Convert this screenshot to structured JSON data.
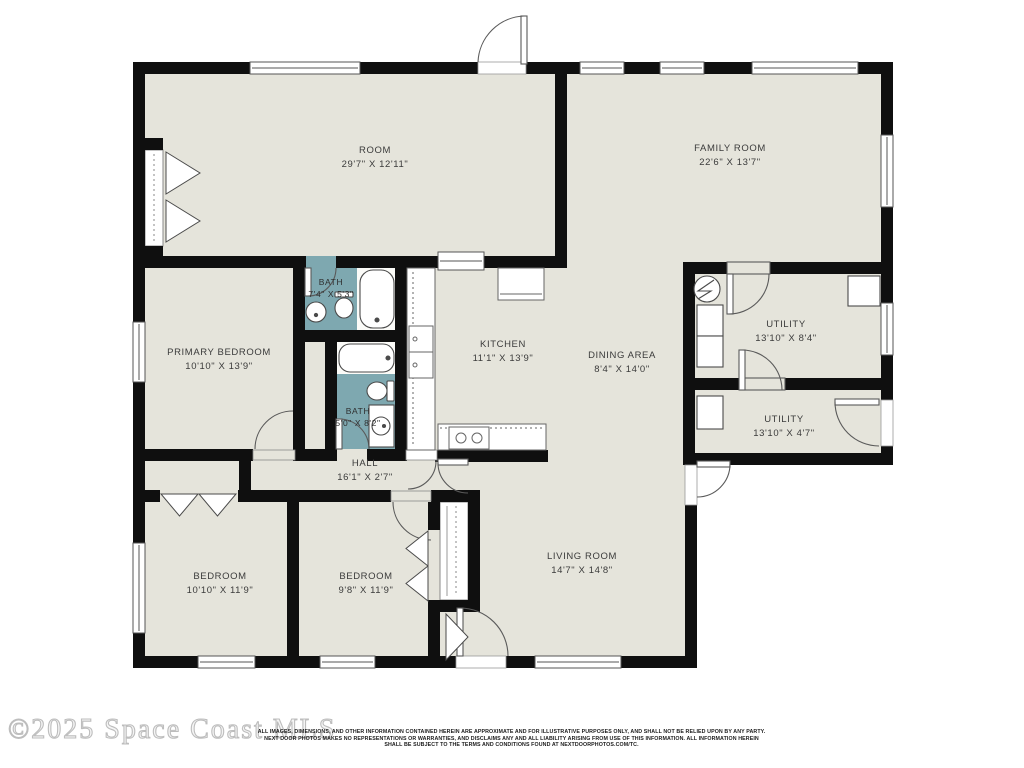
{
  "colors": {
    "floor": "#e5e4db",
    "bath": "#7ea8b0",
    "wall": "#0f0f0f"
  },
  "rooms": [
    {
      "id": "room",
      "name": "ROOM",
      "dims": "29'7\" X 12'11\""
    },
    {
      "id": "family-room",
      "name": "FAMILY ROOM",
      "dims": "22'6\" X 13'7\""
    },
    {
      "id": "bath-1",
      "name": "BATH",
      "dims": "7'4\" X 5'3\""
    },
    {
      "id": "primary-bedroom",
      "name": "PRIMARY BEDROOM",
      "dims": "10'10\" X 13'9\""
    },
    {
      "id": "kitchen",
      "name": "KITCHEN",
      "dims": "11'1\" X 13'9\""
    },
    {
      "id": "dining-area",
      "name": "DINING AREA",
      "dims": "8'4\" X 14'0\""
    },
    {
      "id": "utility-1",
      "name": "UTILITY",
      "dims": "13'10\" X 8'4\""
    },
    {
      "id": "bath-2",
      "name": "BATH",
      "dims": "5'0\" X 8'2\""
    },
    {
      "id": "utility-2",
      "name": "UTILITY",
      "dims": "13'10\" X 4'7\""
    },
    {
      "id": "hall",
      "name": "HALL",
      "dims": "16'1\" X 2'7\""
    },
    {
      "id": "bedroom-1",
      "name": "BEDROOM",
      "dims": "10'10\" X 11'9\""
    },
    {
      "id": "bedroom-2",
      "name": "BEDROOM",
      "dims": "9'8\" X 11'9\""
    },
    {
      "id": "living-room",
      "name": "LIVING ROOM",
      "dims": "14'7\" X 14'8\""
    }
  ],
  "icons": {
    "water-heater": "circle-with-zigzag",
    "bathtub": "rounded-rect",
    "toilet": "ellipse-with-tank",
    "sink": "circle-basin",
    "stove": "box-with-two-burners",
    "refrigerator": "box",
    "washer-dryer": "stacked-boxes"
  },
  "footer": {
    "watermark": "©2025 Space Coast MLS",
    "disclaimer_line1": "ALL IMAGES, DIMENSIONS, AND OTHER INFORMATION CONTAINED HEREIN ARE APPROXIMATE AND FOR ILLUSTRATIVE PURPOSES ONLY, AND SHALL NOT BE RELIED UPON BY ANY PARTY.",
    "disclaimer_line2": "NEXT DOOR PHOTOS MAKES NO REPRESENTATIONS OR WARRANTIES, AND DISCLAIMS ANY AND ALL LIABILITY ARISING FROM USE OF THIS INFORMATION. ALL INFORMATION HEREIN",
    "disclaimer_line3": "SHALL BE SUBJECT TO THE TERMS AND CONDITIONS FOUND AT NEXTDOORPHOTOS.COM/TC."
  }
}
